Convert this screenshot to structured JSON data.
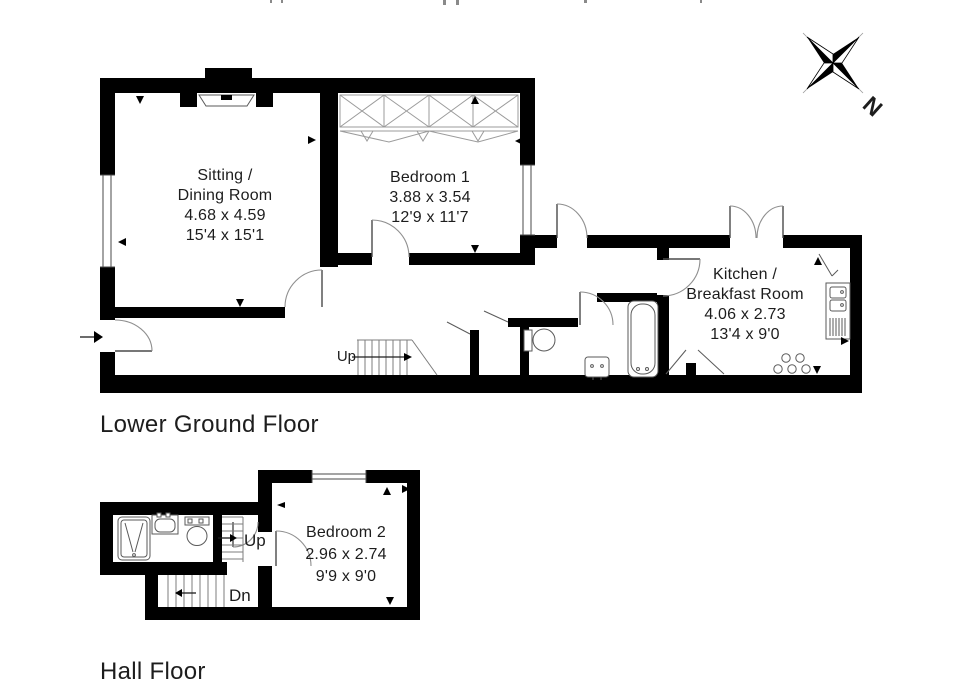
{
  "compass": {
    "north_label": "N"
  },
  "plans": {
    "lower": {
      "floor_label": "Lower Ground Floor",
      "stairs_up_label": "Up",
      "rooms": {
        "sitting": {
          "lines": [
            "Sitting /",
            "Dining Room",
            "4.68 x 4.59",
            "15'4 x 15'1"
          ]
        },
        "bedroom1": {
          "lines": [
            "Bedroom 1",
            "3.88 x 3.54",
            "12'9 x 11'7"
          ]
        },
        "kitchen": {
          "lines": [
            "Kitchen /",
            "Breakfast Room",
            "4.06 x 2.73",
            "13'4 x 9'0"
          ]
        }
      }
    },
    "hall": {
      "floor_label": "Hall Floor",
      "stairs_up_label": "Up",
      "stairs_down_label": "Dn",
      "rooms": {
        "bedroom2": {
          "lines": [
            "Bedroom 2",
            "2.96 x 2.74",
            "9'9 x 9'0"
          ]
        }
      }
    }
  },
  "colors": {
    "walls": "#000000",
    "label_text": "#1d1d1d",
    "fixture_lines": "#5a5a5a",
    "door_arcs": "#8f8f8f"
  }
}
